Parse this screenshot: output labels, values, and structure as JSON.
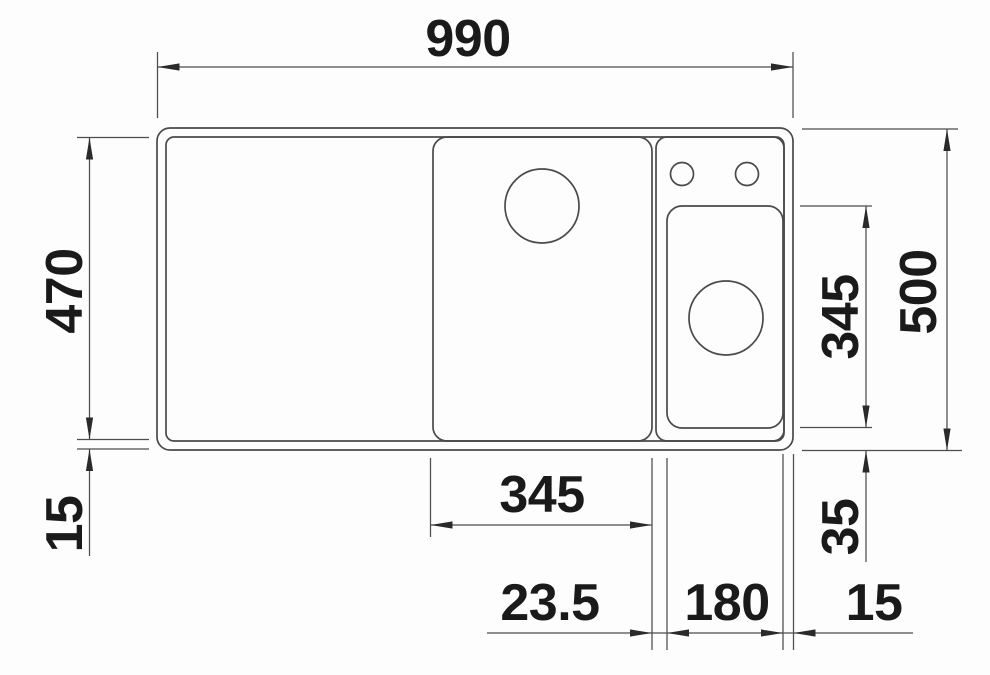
{
  "drawing": {
    "kind": "technical-dimension-drawing",
    "subject": "kitchen sink top view with bowl and rim dimensions",
    "dims": {
      "overall_width": "990",
      "overall_depth": "500",
      "inner_depth": "470",
      "rim_bottom": "15",
      "accessory_bowl_depth": "345",
      "accessory_bowl_bottom_offset": "35",
      "main_bowl_width": "345",
      "bowl_gap": "23.5",
      "accessory_bowl_width": "180",
      "rim_right": "15"
    },
    "colors": {
      "outline": "#4a4a4a",
      "dimension_lines": "#4d4d4d",
      "text": "#1a1a1a",
      "background": "#fdfdfd"
    }
  }
}
